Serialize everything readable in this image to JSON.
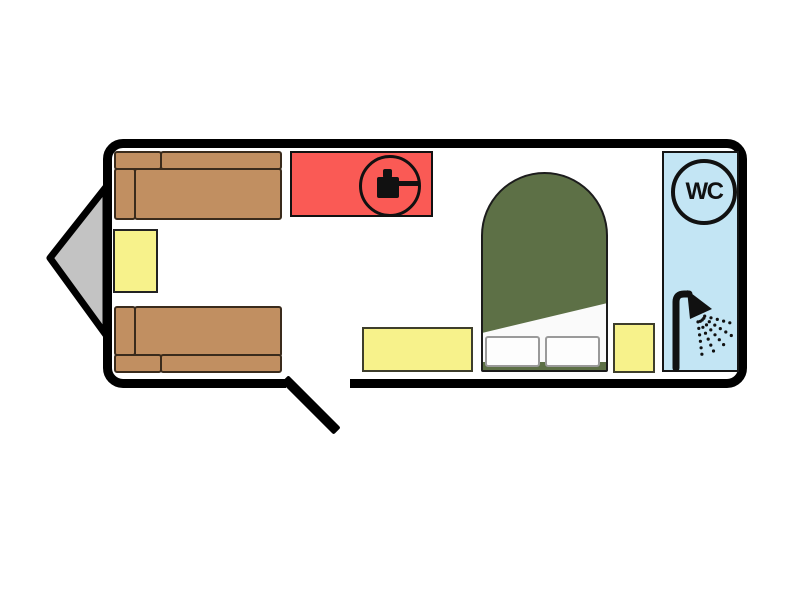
{
  "plan": {
    "kind": "caravan-floor-plan",
    "bathroom": {
      "wc_label": "WC",
      "icons": [
        "wc-roundel",
        "shower-head-spray"
      ]
    },
    "kitchen": {
      "icon": "pot-on-hob"
    },
    "bedroom": {
      "bed": "double-bed-island",
      "pillow_count": 2,
      "bedside_units": 2
    },
    "lounge": {
      "sofas": 2,
      "table": "side-table"
    },
    "features": [
      "tow-hitch-triangle",
      "entry-door-open"
    ],
    "colors": {
      "outline": "#000000",
      "sofa": "#c18f61",
      "unit_yellow": "#f7f28b",
      "kitchen_red": "#fa5a55",
      "bed_green": "#5d7046",
      "bathroom_blue": "#c3e5f4",
      "hitch_gray": "#c3c3c3",
      "pillow_white": "#fdfdfd"
    }
  }
}
